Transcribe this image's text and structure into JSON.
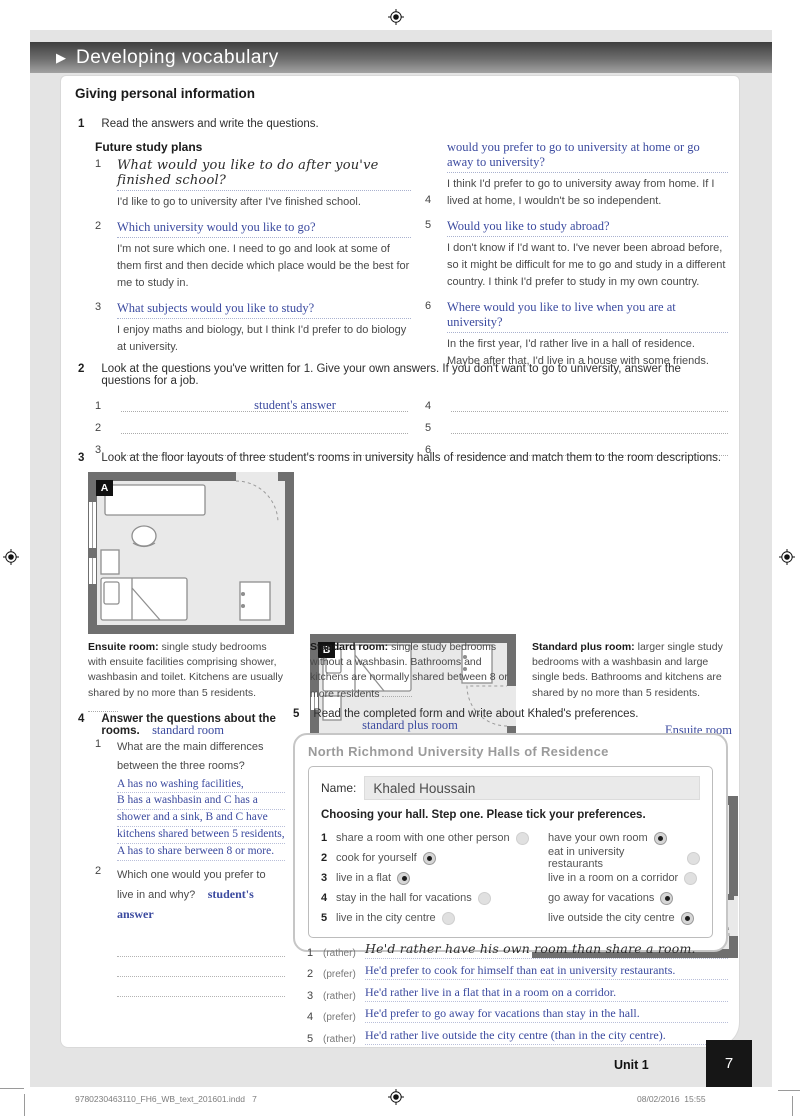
{
  "banner": {
    "title": "Developing vocabulary"
  },
  "section_title": "Giving personal information",
  "exercise1": {
    "number": "1",
    "instruction": "Read the answers and write the questions.",
    "subtitle": "Future study plans",
    "items": [
      {
        "num": "1",
        "question": "What would you like to do after you've finished school?",
        "answer": "I'd like to go to university after I've finished school."
      },
      {
        "num": "2",
        "question": "Which university would you like to go?",
        "answer": "I'm not sure which one. I need to go and look at some of them first and then decide which place would be the best for me to study in."
      },
      {
        "num": "3",
        "question": "What subjects would you like to study?",
        "answer": "I enjoy maths and biology, but I think I'd prefer to do biology at university."
      },
      {
        "num": "4",
        "question": "would you prefer to go to university at home or go away to university?",
        "answer": "I think I'd prefer to go to university away from home. If I lived at home, I wouldn't be so independent."
      },
      {
        "num": "5",
        "question": "Would you like to study abroad?",
        "answer": "I don't know if I'd want to. I've never been abroad before, so it might be difficult for me to go and study in a different country. I think I'd prefer to study in my own country."
      },
      {
        "num": "6",
        "question": "Where would you like to live when you are at university?",
        "answer": "In the first year, I'd rather live in a hall of residence. Maybe after that, I'd live in a house with some friends."
      }
    ]
  },
  "exercise2": {
    "number": "2",
    "instruction": "Look at the questions you've written for 1. Give your own answers. If you don't want to go to university, answer the questions for a job.",
    "note": "student's answer",
    "nums": [
      "1",
      "2",
      "3",
      "4",
      "5",
      "6"
    ]
  },
  "exercise3": {
    "number": "3",
    "instruction": "Look at the floor layouts of three student's rooms in university halls of residence and match them to the room descriptions.",
    "plans": [
      {
        "label": "A"
      },
      {
        "label": "B"
      },
      {
        "label": "C"
      }
    ],
    "descriptions": [
      {
        "title": "Ensuite room:",
        "text": "single study bedrooms with ensuite facilities comprising shower, washbasin and toilet. Kitchens are usually shared by no more than 5 residents.",
        "answer": "standard room"
      },
      {
        "title": "Standard room:",
        "text": "single study bedrooms without a washbasin. Bathrooms and kitchens are normally shared between 8 or more residents",
        "answer": "standard plus room"
      },
      {
        "title": "Standard plus room:",
        "text": "larger single study bedrooms with a washbasin and large single beds. Bathrooms and kitchens are shared by no more than 5 residents.",
        "answer": "Ensuite room"
      }
    ]
  },
  "exercise4": {
    "number": "4",
    "instruction": "Answer the questions about the rooms.",
    "q1": {
      "num": "1",
      "text": "What are the main differences between the three rooms?",
      "answer_lines": [
        "A has no washing facilities,",
        "B has a washbasin and C has a",
        "shower and a sink, B and C have",
        "kitchens shared between 5 residents,",
        "A has to share berween 8 or more."
      ]
    },
    "q2": {
      "num": "2",
      "text": "Which one would you prefer to live in and why?",
      "answer": "student's answer"
    }
  },
  "exercise5": {
    "number": "5",
    "instruction": "Read the completed form and write about Khaled's preferences.",
    "form": {
      "title": "North Richmond University Halls of Residence",
      "name_label": "Name:",
      "name_value": "Khaled Houssain",
      "subtitle": "Choosing your hall. Step one. Please tick your preferences.",
      "rows": [
        {
          "num": "1",
          "left": "share a room with one other person",
          "left_checked": false,
          "right": "have your own room",
          "right_checked": true
        },
        {
          "num": "2",
          "left": "cook for yourself",
          "left_checked": true,
          "right": "eat in university restaurants",
          "right_checked": false
        },
        {
          "num": "3",
          "left": "live in a flat",
          "left_checked": true,
          "right": "live in a room on a corridor",
          "right_checked": false
        },
        {
          "num": "4",
          "left": "stay in the hall for vacations",
          "left_checked": false,
          "right": "go away for vacations",
          "right_checked": true
        },
        {
          "num": "5",
          "left": "live in the city centre",
          "left_checked": false,
          "right": "live outside the city centre",
          "right_checked": true
        }
      ]
    },
    "answers": [
      {
        "num": "1",
        "hint": "(rather)",
        "text": "He'd rather have his own room than share a room."
      },
      {
        "num": "2",
        "hint": "(prefer)",
        "text": "He'd prefer to cook for himself than eat in university restaurants."
      },
      {
        "num": "3",
        "hint": "(rather)",
        "text": "He'd rather live in a flat that in a room on a corridor."
      },
      {
        "num": "4",
        "hint": "(prefer)",
        "text": "He'd prefer to go away for vacations than stay in the hall."
      },
      {
        "num": "5",
        "hint": "(rather)",
        "text": "He'd rather live outside the city centre (than in the city centre)."
      }
    ]
  },
  "footer": {
    "unit": "Unit 1",
    "page": "7",
    "print_file": "9780230463110_FH6_WB_text_201601.indd",
    "print_page": "7",
    "date": "08/02/2016",
    "time": "15:55"
  },
  "colors": {
    "answer_blue": "#3b4a9f",
    "page_gray": "#e4e4e4",
    "wall_gray": "#6f6f6f"
  }
}
